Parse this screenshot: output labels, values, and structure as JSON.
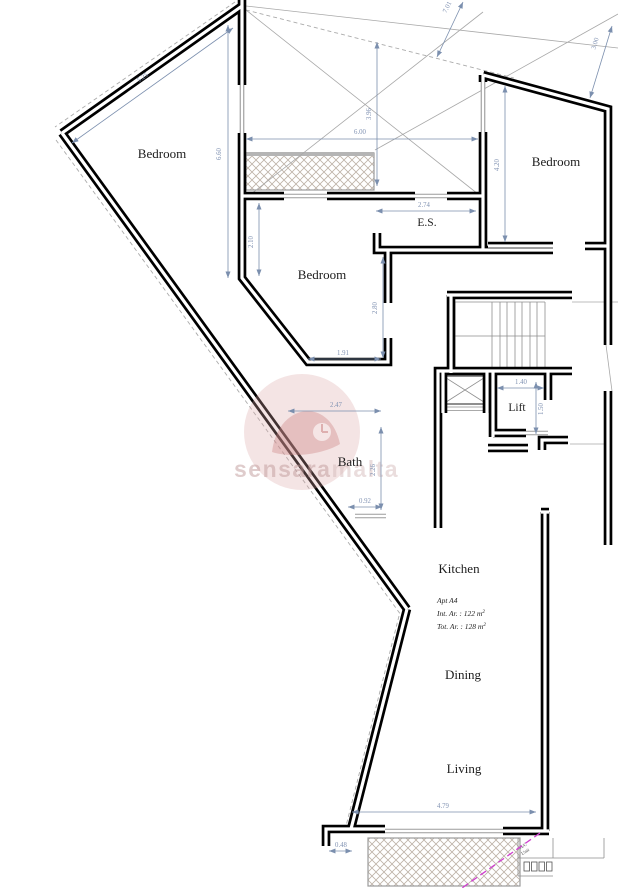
{
  "rooms": {
    "bedroom_left": "Bedroom",
    "bedroom_right": "Bedroom",
    "bedroom_middle": "Bedroom",
    "ensuite": "E.S.",
    "bath": "Bath",
    "lift": "Lift",
    "kitchen": "Kitchen",
    "dining": "Dining",
    "living": "Living"
  },
  "dimensions": {
    "top_left_diagonal": "5.25",
    "left_height": "6.60",
    "terrace_width": "6.00",
    "terrace_height": "3.96",
    "top_cut": "7.01",
    "roof_offset": "3.00",
    "bedroom2_inner_height": "2.10",
    "es_width": "2.74",
    "right_bedroom_height": "4.20",
    "bedroom2_recess_height": "2.80",
    "bedroom2_recess_width": "1.91",
    "bath_width": "2.47",
    "bath_height": "2.26",
    "bath_door": "0.92",
    "lift_width": "1.40",
    "lift_depth": "1.50",
    "living_width": "4.79",
    "step_width": "0.48"
  },
  "apartment": {
    "name": "Apt A4",
    "int_area": "Int. Ar. : 122 m",
    "tot_area": "Tot. Ar. : 128 m",
    "area_sup": "2"
  },
  "watermark": {
    "primary": "sensara",
    "secondary": "malta"
  },
  "ac_unit": {
    "line1": "A/C",
    "line2": "Unit"
  },
  "colors": {
    "wall": "#000000",
    "dimension": "#7b8fae",
    "window": "#9a9a9a",
    "hatch": "#b9ae9f",
    "magenta": "#cf3fcf",
    "watermark_pink": "#d9a0a0"
  }
}
